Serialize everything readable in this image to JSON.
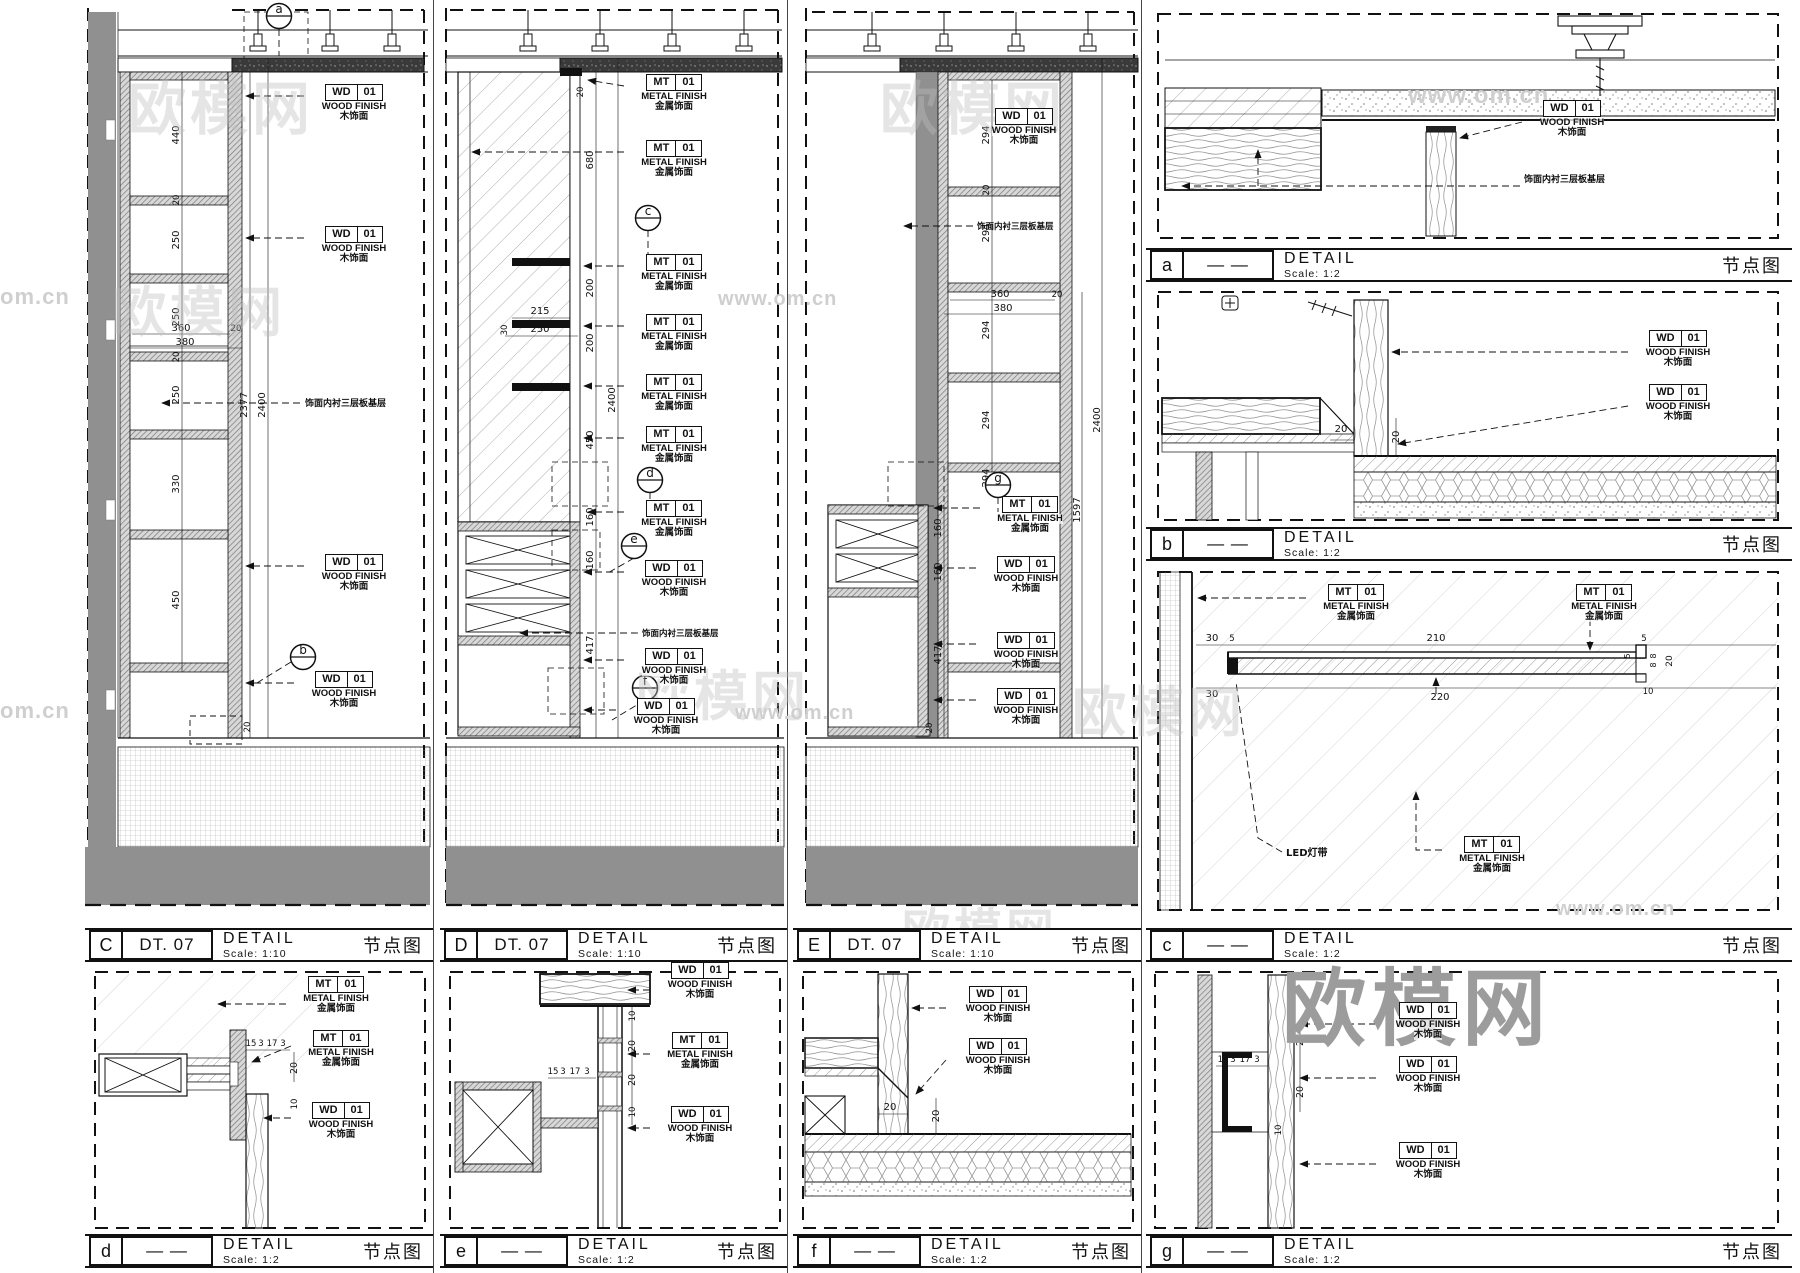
{
  "tags": {
    "wd": {
      "code": "WD",
      "num": "01",
      "line1": "WOOD FINISH",
      "line2": "木饰面"
    },
    "mt": {
      "code": "MT",
      "num": "01",
      "line1": "METAL FINISH",
      "line2": "金属饰面"
    }
  },
  "notes": {
    "ply": "饰面内衬三层板基层",
    "led": "LED灯带"
  },
  "bubbles": {
    "a": "a",
    "b": "b",
    "c": "c",
    "d": "d",
    "e": "e",
    "f": "f",
    "g": "g"
  },
  "watermark": {
    "brand": "欧模网",
    "site": "www.om.cn",
    "partial": "om.cn"
  },
  "titles": {
    "C": {
      "letter": "C",
      "code": "DT. 07",
      "name": "DETAIL",
      "scale": "Scale: 1:10",
      "cn": "节点图"
    },
    "D": {
      "letter": "D",
      "code": "DT. 07",
      "name": "DETAIL",
      "scale": "Scale: 1:10",
      "cn": "节点图"
    },
    "E": {
      "letter": "E",
      "code": "DT. 07",
      "name": "DETAIL",
      "scale": "Scale: 1:10",
      "cn": "节点图"
    },
    "a": {
      "letter": "a",
      "code": "— —",
      "name": "DETAIL",
      "scale": "Scale: 1:2",
      "cn": "节点图"
    },
    "b": {
      "letter": "b",
      "code": "— —",
      "name": "DETAIL",
      "scale": "Scale: 1:2",
      "cn": "节点图"
    },
    "c": {
      "letter": "c",
      "code": "— —",
      "name": "DETAIL",
      "scale": "Scale: 1:2",
      "cn": "节点图"
    },
    "d": {
      "letter": "d",
      "code": "— —",
      "name": "DETAIL",
      "scale": "Scale: 1:2",
      "cn": "节点图"
    },
    "e": {
      "letter": "e",
      "code": "— —",
      "name": "DETAIL",
      "scale": "Scale: 1:2",
      "cn": "节点图"
    },
    "f": {
      "letter": "f",
      "code": "— —",
      "name": "DETAIL",
      "scale": "Scale: 1:2",
      "cn": "节点图"
    },
    "g": {
      "letter": "g",
      "code": "— —",
      "name": "DETAIL",
      "scale": "Scale: 1:2",
      "cn": "节点图"
    }
  },
  "panels": {
    "C": {
      "dims": [
        "440",
        "250",
        "250",
        "250",
        "330",
        "450",
        "20",
        "20",
        "360",
        "380",
        "20",
        "2377",
        "2400",
        "20"
      ]
    },
    "D": {
      "dims": [
        "680",
        "200",
        "200",
        "450",
        "160",
        "160",
        "417",
        "2400",
        "215",
        "250",
        "30",
        "20"
      ]
    },
    "E": {
      "dims": [
        "294",
        "294",
        "294",
        "294",
        "294",
        "360",
        "380",
        "20",
        "1597",
        "2400",
        "160",
        "160",
        "417",
        "20",
        "20"
      ]
    },
    "b": {
      "dims": [
        "20",
        "20"
      ]
    },
    "c": {
      "dims": [
        "30",
        "5",
        "210",
        "5",
        "30",
        "220",
        "8",
        "8",
        "20",
        "10",
        "5"
      ]
    },
    "d": {
      "dims": [
        "15",
        "3",
        "17",
        "3",
        "20",
        "10"
      ]
    },
    "e": {
      "dims": [
        "15",
        "3",
        "17",
        "3",
        "10",
        "20",
        "20",
        "10"
      ]
    },
    "f": {
      "dims": [
        "20",
        "20"
      ]
    },
    "g": {
      "dims": [
        "15",
        "3",
        "17",
        "3",
        "20",
        "20",
        "10"
      ]
    }
  }
}
